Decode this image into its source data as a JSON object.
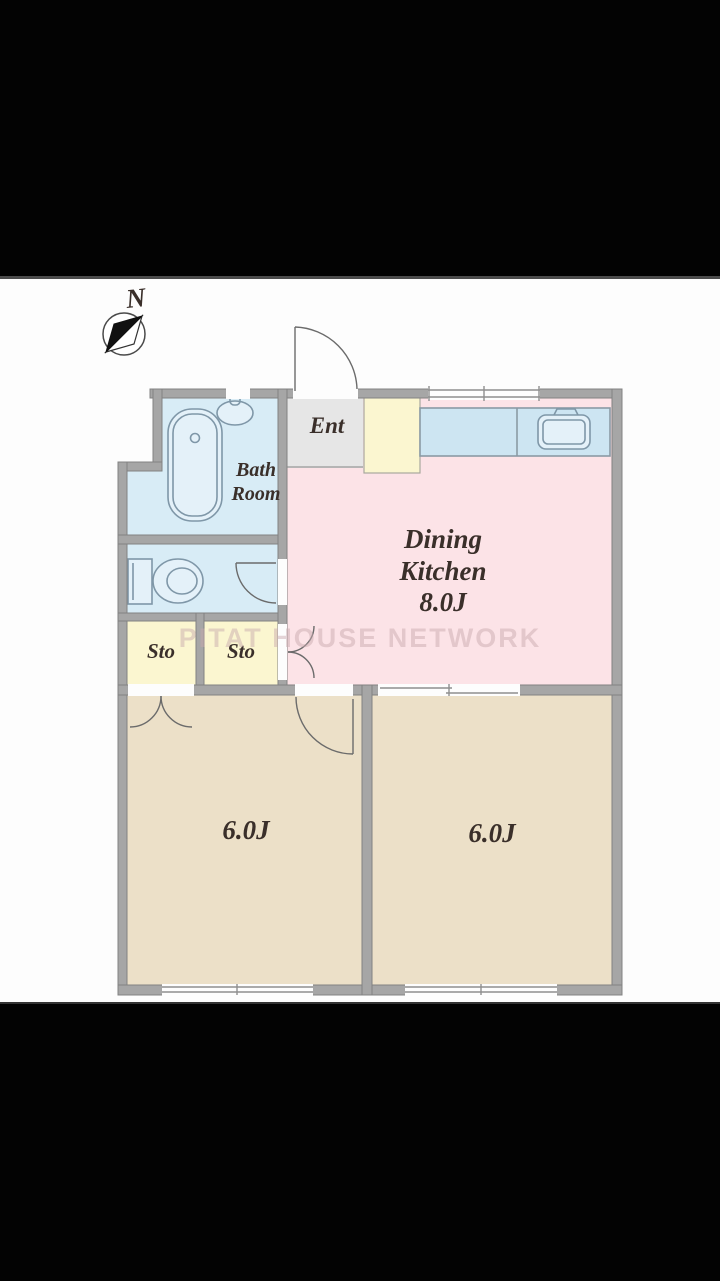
{
  "compass": {
    "label": "N"
  },
  "watermark": "PITAT HOUSE NETWORK",
  "rooms": {
    "entrance": {
      "label": "Ent"
    },
    "bathroom": {
      "label": "Bath Room"
    },
    "storage_left": {
      "label": "Sto"
    },
    "storage_right": {
      "label": "Sto"
    },
    "dining_kitchen": {
      "label": "Dining Kitchen",
      "size": "8.0J"
    },
    "room_left": {
      "size": "6.0J"
    },
    "room_right": {
      "size": "6.0J"
    }
  },
  "colors": {
    "dining_kitchen": "#fce3e7",
    "western_room": "#ece0c8",
    "wet_area": "#d8ecf6",
    "fixture_fill": "#e4f1f9",
    "storage": "#fbf6d0",
    "entrance": "#e6e6e6",
    "wall": "#a6a6a6",
    "wall_edge": "#828282",
    "fixture_line": "#7f97a8",
    "door_line": "#6b6b6b",
    "text": "#3a2f2a",
    "watermark": "#c9a9ae"
  }
}
